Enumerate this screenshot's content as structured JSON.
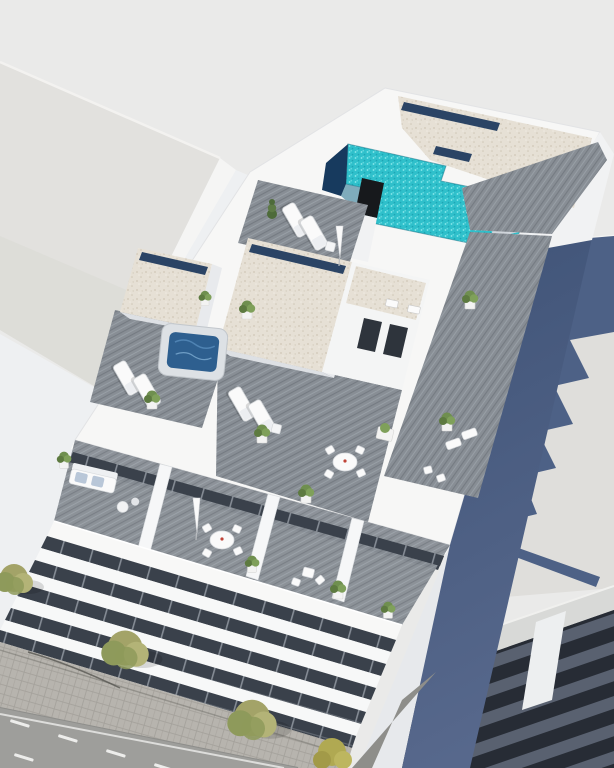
{
  "meta": {
    "kind": "3d-architectural-render",
    "view": "aerial-oblique",
    "subject": "Modern white apartment building with rooftop pool, terraces and street"
  },
  "palette": {
    "background": "#eaeae9",
    "neighbor_roof_left": "#e2e1de",
    "neighbor_roof_left_shade": "#dcdbd6",
    "neighbor_wall_left": "#f5f5f4",
    "nw_wall": "#eef0f2",
    "building_white": "#f7f7f6",
    "parapet_white": "#f1f2f3",
    "wall_shade": "#e0e3e7",
    "wall_shade_dark": "#d6dade",
    "gravel": "#e6e0d5",
    "gravel_dot_dark": "#d0c7b7",
    "gravel_dot_light": "#f0ebe2",
    "skylight_navy": "#2b4465",
    "pool_water": "#2fc0cb",
    "pool_sparkle": "#8ce9ec",
    "pool_ripple": "#1ea5b4",
    "pool_deep": "#173a5e",
    "shower_black": "#17191c",
    "deck_wood": "#888e95",
    "deck_seam": "#757b82",
    "deck_streak": "#9aa1a8",
    "glazing_dark": "#3a414b",
    "glazing_frame": "#848b94",
    "hot_tub_water": "#2e5f8f",
    "hot_tub_rim": "#dde1e5",
    "side_wall_navy_top": "#3f5377",
    "side_wall_navy_bottom": "#57688c",
    "shadow_navy": "#4d6186",
    "neighbor_roof_right": "#dfdedb",
    "slab_gray": "#d8d9d7",
    "louver_dark": "#272c35",
    "louver_gray": "#596170",
    "asphalt": "#9e9e9b",
    "sidewalk": "#b7b4ae",
    "paver_line": "#a5a29c",
    "road_marking": "#ededeb",
    "tree_olive": "#a3a368",
    "tree_dark": "#8e9a5b",
    "tree_light": "#b3b377",
    "bush_yellow": "#b0a952",
    "plant_green": "#6f8f4f",
    "plant_green_dark": "#5d7a40",
    "plant_green_light": "#7fa05a",
    "conifer_green": "#4e6b3a",
    "furniture_white": "#fafafa",
    "furniture_stroke": "#d3d6da",
    "cushion_blue": "#b9c7d8",
    "accent_red": "#c04438"
  },
  "scene": {
    "main_building": {
      "name": "main-apartment-building",
      "rooftop": {
        "pool": {
          "water": "turquoise stepped pool",
          "deep_end": "dark navy",
          "outdoor_shower_columns": 1
        },
        "gravel_roof_areas": 3,
        "skylight_strips": 4,
        "stair_steps": 5,
        "hot_tubs": 1,
        "sun_loungers": 6,
        "dining_sets": 1,
        "roof_vents": 2,
        "core_windows": 2,
        "potted_plants": 7,
        "conifers": 1,
        "closed_umbrellas": 1
      },
      "balconies": {
        "count": 4,
        "sofa_sets": 1,
        "dining_sets": 1,
        "bistro_sets": 1,
        "closed_umbrellas": 1,
        "potted_plants": 4
      },
      "facade": {
        "white_band_floors": 5,
        "glazing": "dark recessed"
      },
      "side_wall": "navy blue"
    },
    "neighbor_left": {
      "name": "neighbor-building-left",
      "roof": "plain light gray flat roof"
    },
    "neighbor_right": {
      "name": "neighbor-building-right",
      "roof": "light gray flat roof with stepped cast shadow of main building and flagpole spike",
      "facade": "dark louver bands over parking levels"
    },
    "street": {
      "dashed_lane_markings": 2,
      "edge_line": 1,
      "sidewalk": "paved",
      "trees": 3,
      "lamp_shadows": 1,
      "yellow_bushes": 1
    }
  }
}
